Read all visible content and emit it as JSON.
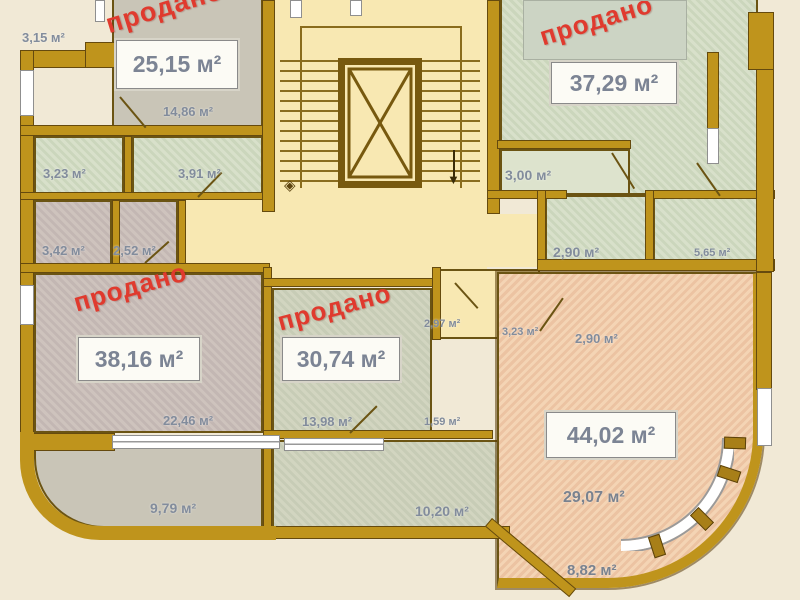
{
  "stamp": {
    "text": "продано",
    "color": "#e03a2e"
  },
  "areas": {
    "balcony_315": "3,15 м²",
    "room_2515": "25,15 м²",
    "room_1486": "14,86 м²",
    "room_323": "3,23 м²",
    "room_391": "3,91 м²",
    "room_342": "3,42 м²",
    "room_252": "2,52 м²",
    "room_3729": "37,29 м²",
    "room_300": "3,00 м²",
    "room_290a": "2,90 м²",
    "room_565": "5,65 м²",
    "room_3816": "38,16 м²",
    "room_3074": "30,74 м²",
    "room_297": "2,97 м²",
    "room_323b": "3,23 м²",
    "room_290b": "2,90 м²",
    "room_2246": "22,46 м²",
    "room_1398": "13,98 м²",
    "room_159": "1,59 м²",
    "room_4402": "44,02 м²",
    "room_2907": "29,07 м²",
    "balcony_882": "8,82 м²",
    "room_979": "9,79 м²",
    "room_1020": "10,20 м²"
  },
  "colors": {
    "wall": "#bf941c",
    "wall_edge": "#654a0e",
    "corridor": "#f8e8b2",
    "room_grey": "#c9c5b7",
    "room_green": "#d4dcc6",
    "room_mauve": "#c8bdb8",
    "room_pink": "#f0cdae",
    "background": "#f1e9d6",
    "label_text": "#828c9c",
    "sold_red": "#e03a2e"
  }
}
